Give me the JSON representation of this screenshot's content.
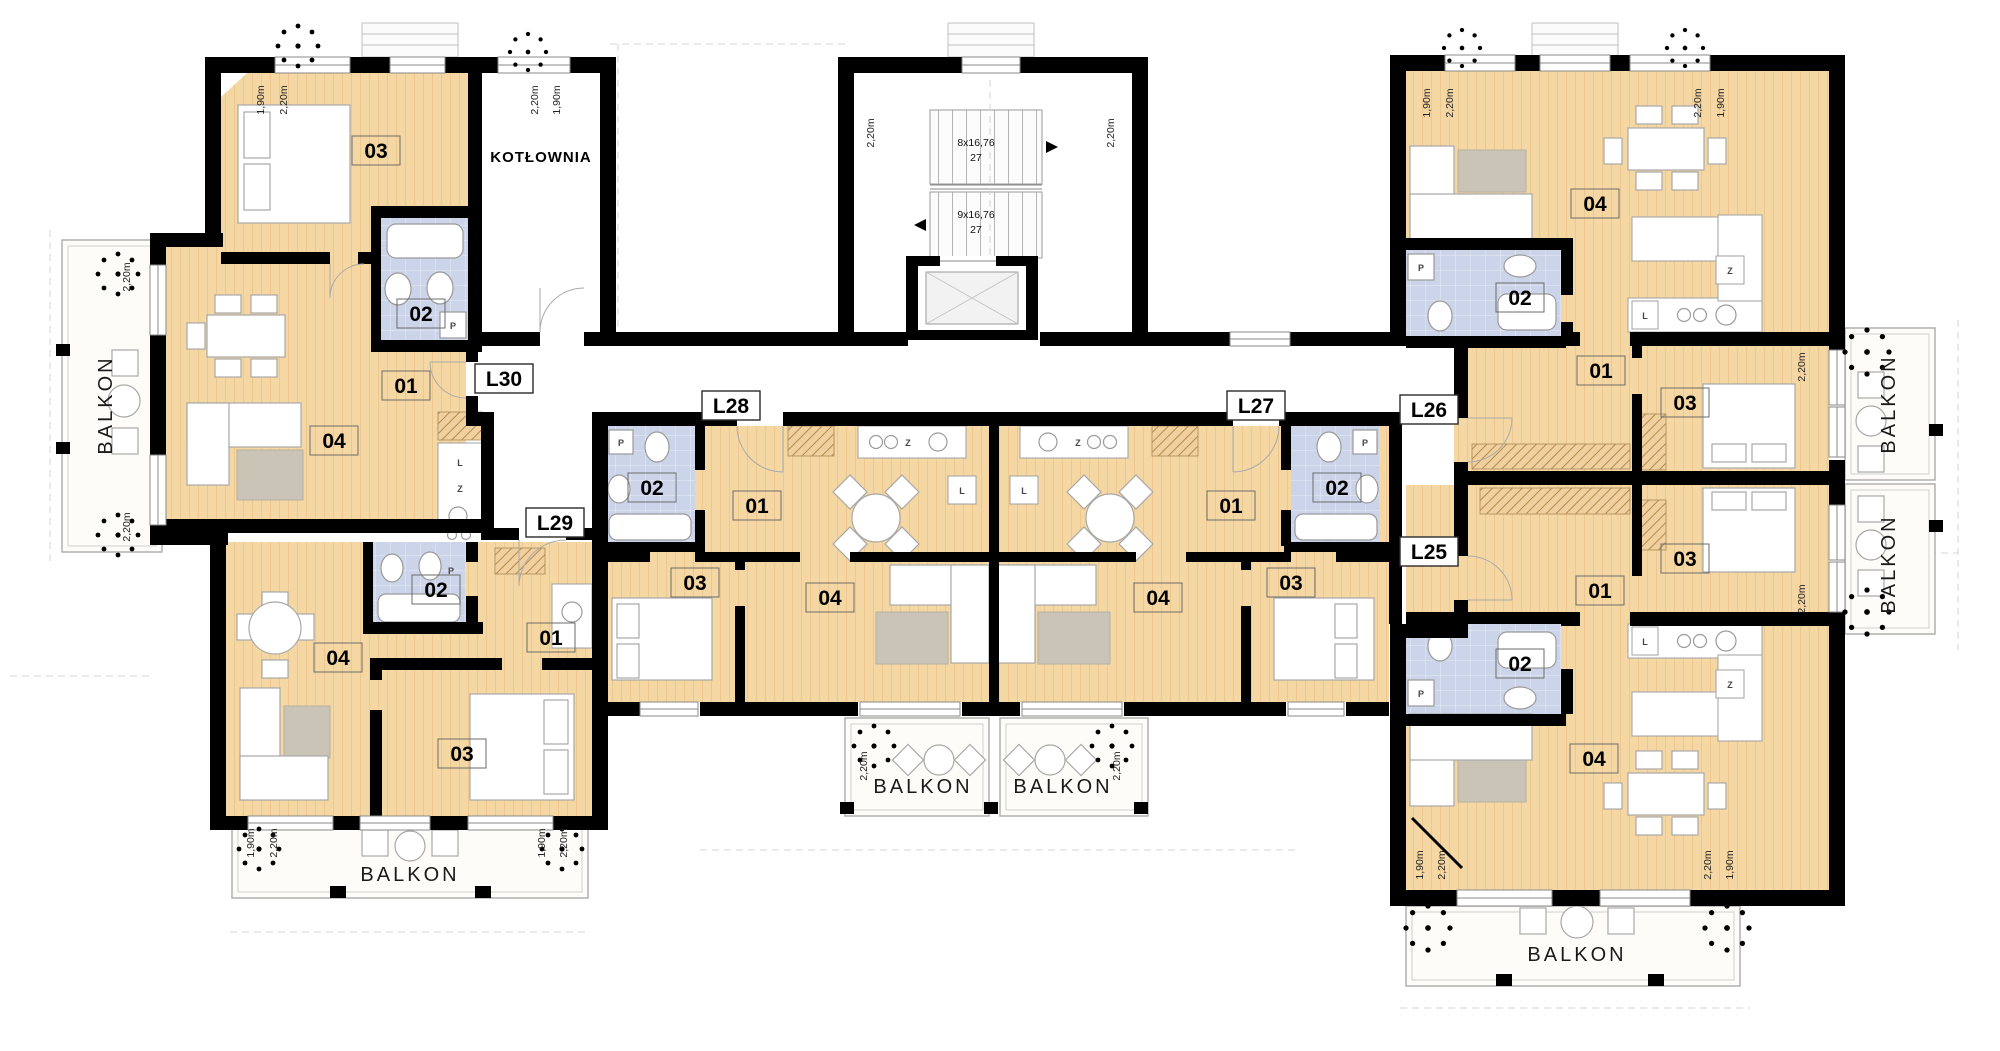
{
  "floor_plan": {
    "balcony": "BALKON",
    "boiler_room": "KOTŁOWNIA",
    "rooms": {
      "hall": "01",
      "bath": "02",
      "bedroom": "03",
      "living": "04"
    },
    "units": {
      "l25": "L25",
      "l26": "L26",
      "l27": "L27",
      "l28": "L28",
      "l29": "L29",
      "l30": "L30"
    },
    "stairs": {
      "upper_flight": "8x16,76",
      "upper_steps": "27",
      "lower_flight": "9x16,76",
      "lower_steps": "27"
    },
    "dims": {
      "d190": "1,90m",
      "d220": "2,20m"
    },
    "appliances": {
      "fridge": "L",
      "dishwasher": "Z",
      "washer": "P"
    },
    "colors": {
      "floor": "#f5d7a3",
      "bath": "#ccd4e9",
      "wall": "#000000",
      "balcony": "#fdfcf9",
      "tree": "#49b649"
    }
  }
}
